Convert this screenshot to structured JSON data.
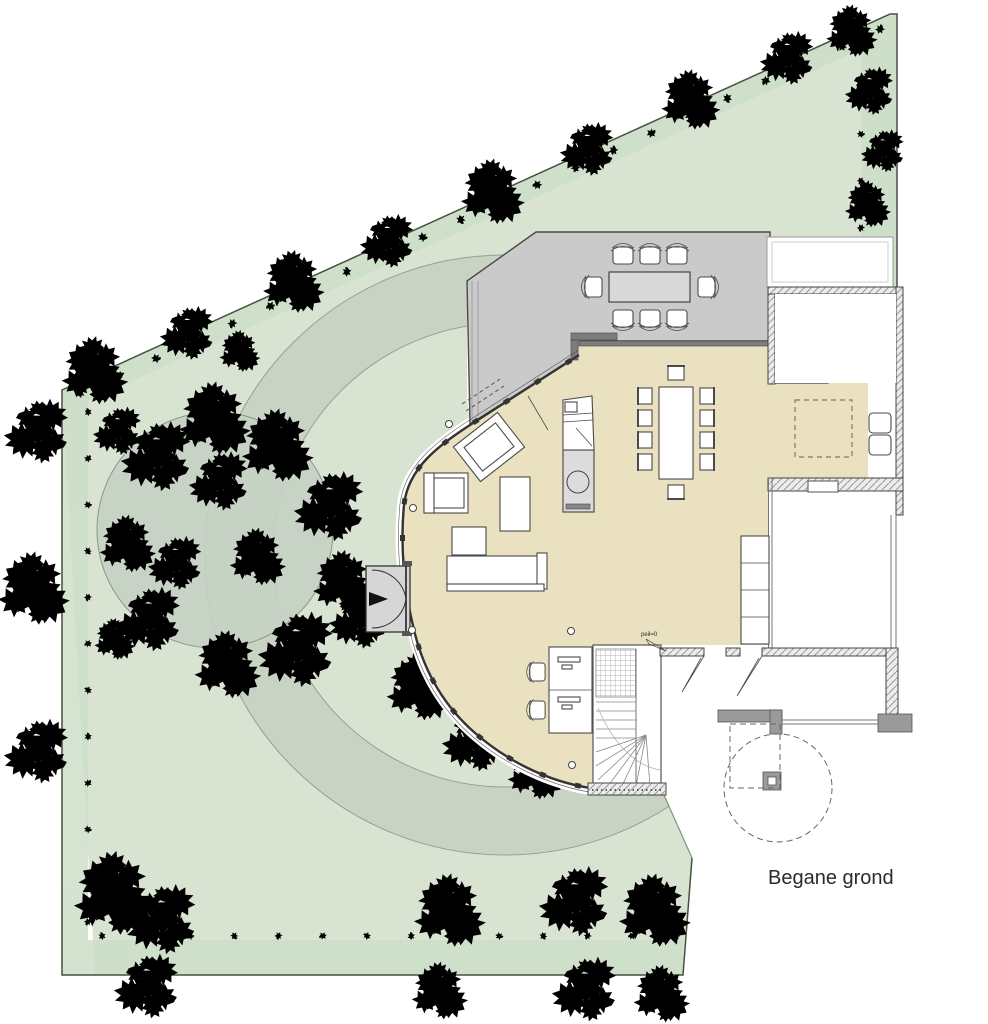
{
  "labels": {
    "title": "Begane grond",
    "level_marker": "peil=0"
  },
  "colors": {
    "paper": "#ffffff",
    "garden": "#d8e4d1",
    "hedge_band": "#cddfc8",
    "path": "#c9d3c3",
    "path_edge": "#93a191",
    "canopy": "#c6d2c4",
    "canopy_edge": "#80907e",
    "terrace": "#cacaca",
    "terrace_table": "#d9d9d9",
    "floor": "#eae1c0",
    "wall_dark": "#7d7d7d",
    "line": "#444444",
    "furniture_line": "#4a4a4a",
    "veg_stroke": "#3f4b3d",
    "boundary": "#44503f",
    "pantry_dash": "#8a7a55",
    "text": "#2b2b2b"
  },
  "features": [
    "garden",
    "perimeter-hedges",
    "tree-canopy",
    "curved-walkway",
    "terrace",
    "outdoor-dining",
    "living-area",
    "indoor-dining",
    "kitchen-island",
    "pantry",
    "storage-room",
    "staircase",
    "workspace",
    "entrance",
    "carport-canopy"
  ],
  "furniture_counts": {
    "terrace_dining_chairs": 8,
    "indoor_dining_chairs": 10,
    "desks": 2,
    "desk_chairs": 2,
    "armchairs": 2,
    "sofas": 1
  },
  "vegetation": {
    "clusters": [
      [
        95,
        372,
        1.3
      ],
      [
        190,
        332,
        1.0
      ],
      [
        294,
        283,
        1.2
      ],
      [
        390,
        240,
        1.0
      ],
      [
        493,
        193,
        1.25
      ],
      [
        590,
        148,
        1.0
      ],
      [
        691,
        101,
        1.15
      ],
      [
        790,
        57,
        1.0
      ],
      [
        852,
        32,
        1.0
      ],
      [
        40,
        430,
        1.2
      ],
      [
        34,
        590,
        1.4
      ],
      [
        40,
        750,
        1.2
      ],
      [
        115,
        895,
        1.6
      ],
      [
        120,
        430,
        0.9
      ],
      [
        115,
        640,
        0.8
      ],
      [
        165,
        918,
        1.3
      ],
      [
        450,
        912,
        1.4
      ],
      [
        578,
        900,
        1.3
      ],
      [
        655,
        912,
        1.4
      ],
      [
        150,
        985,
        1.2
      ],
      [
        440,
        992,
        1.1
      ],
      [
        588,
        988,
        1.2
      ],
      [
        662,
        995,
        1.1
      ],
      [
        872,
        90,
        0.9
      ],
      [
        868,
        205,
        0.9
      ],
      [
        885,
        150,
        0.8
      ],
      [
        215,
        420,
        1.4
      ],
      [
        160,
        455,
        1.3
      ],
      [
        278,
        447,
        1.4
      ],
      [
        333,
        505,
        1.3
      ],
      [
        344,
        583,
        1.2
      ],
      [
        300,
        648,
        1.4
      ],
      [
        228,
        666,
        1.3
      ],
      [
        152,
        618,
        1.2
      ],
      [
        128,
        545,
        1.1
      ],
      [
        222,
        480,
        1.1
      ],
      [
        258,
        558,
        1.1
      ],
      [
        178,
        562,
        1.0
      ],
      [
        240,
        352,
        0.8
      ],
      [
        362,
        618,
        1.1
      ],
      [
        420,
        688,
        1.3
      ],
      [
        478,
        738,
        1.2
      ],
      [
        536,
        772,
        1.1
      ]
    ],
    "tuft_rows": [
      {
        "x1": 80,
        "y1": 393,
        "x2": 880,
        "y2": 29,
        "n": 22,
        "s": 0.55
      },
      {
        "x1": 88,
        "y1": 412,
        "x2": 88,
        "y2": 922,
        "n": 12,
        "s": 0.45
      },
      {
        "x1": 102,
        "y1": 936,
        "x2": 676,
        "y2": 936,
        "n": 14,
        "s": 0.45
      },
      {
        "x1": 861,
        "y1": 40,
        "x2": 861,
        "y2": 275,
        "n": 6,
        "s": 0.45
      }
    ]
  }
}
